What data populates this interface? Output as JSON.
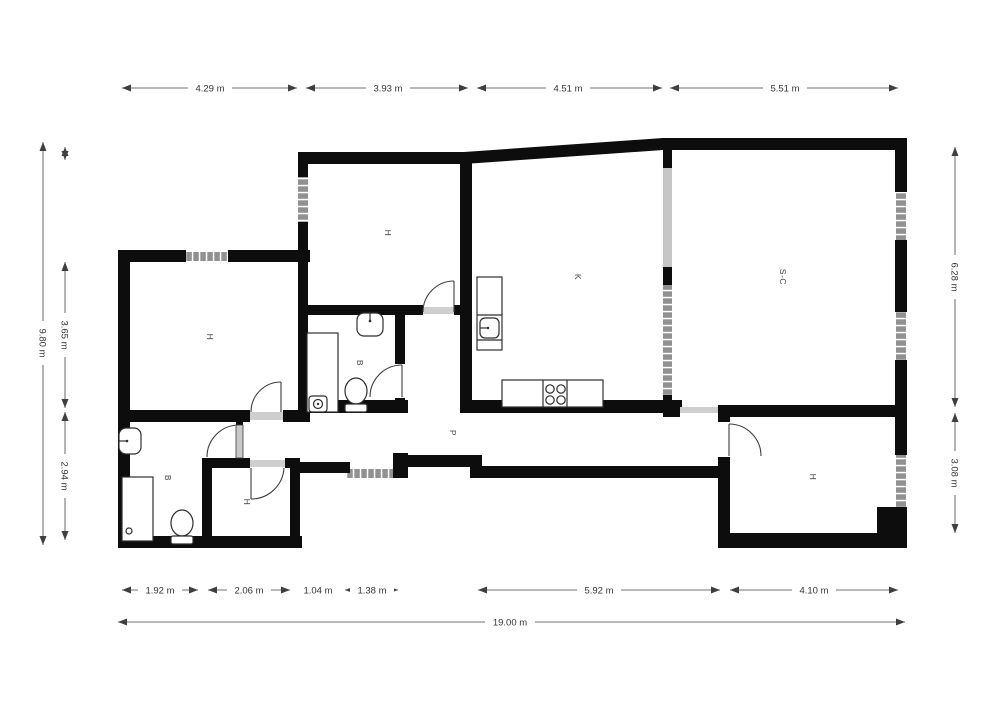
{
  "plan": {
    "rooms": [
      {
        "id": "h1",
        "label": "H"
      },
      {
        "id": "h2",
        "label": "H"
      },
      {
        "id": "h3",
        "label": "H"
      },
      {
        "id": "h4",
        "label": "H"
      },
      {
        "id": "b1",
        "label": "B"
      },
      {
        "id": "b2",
        "label": "B"
      },
      {
        "id": "kitchen",
        "label": "K"
      },
      {
        "id": "salon_comedor",
        "label": "S-C"
      },
      {
        "id": "pasillo",
        "label": "P"
      }
    ],
    "dimensions": {
      "top": [
        "4.29 m",
        "3.93 m",
        "4.51 m",
        "5.51 m"
      ],
      "left": [
        "9.80 m",
        "3.65 m",
        "2.94 m"
      ],
      "right": [
        "6.28 m",
        "3.08 m"
      ],
      "bottom": [
        "1.92 m",
        "2.06 m",
        "1.04 m",
        "1.38 m",
        "5.92 m",
        "4.10 m"
      ],
      "overall": "19.00 m"
    }
  }
}
